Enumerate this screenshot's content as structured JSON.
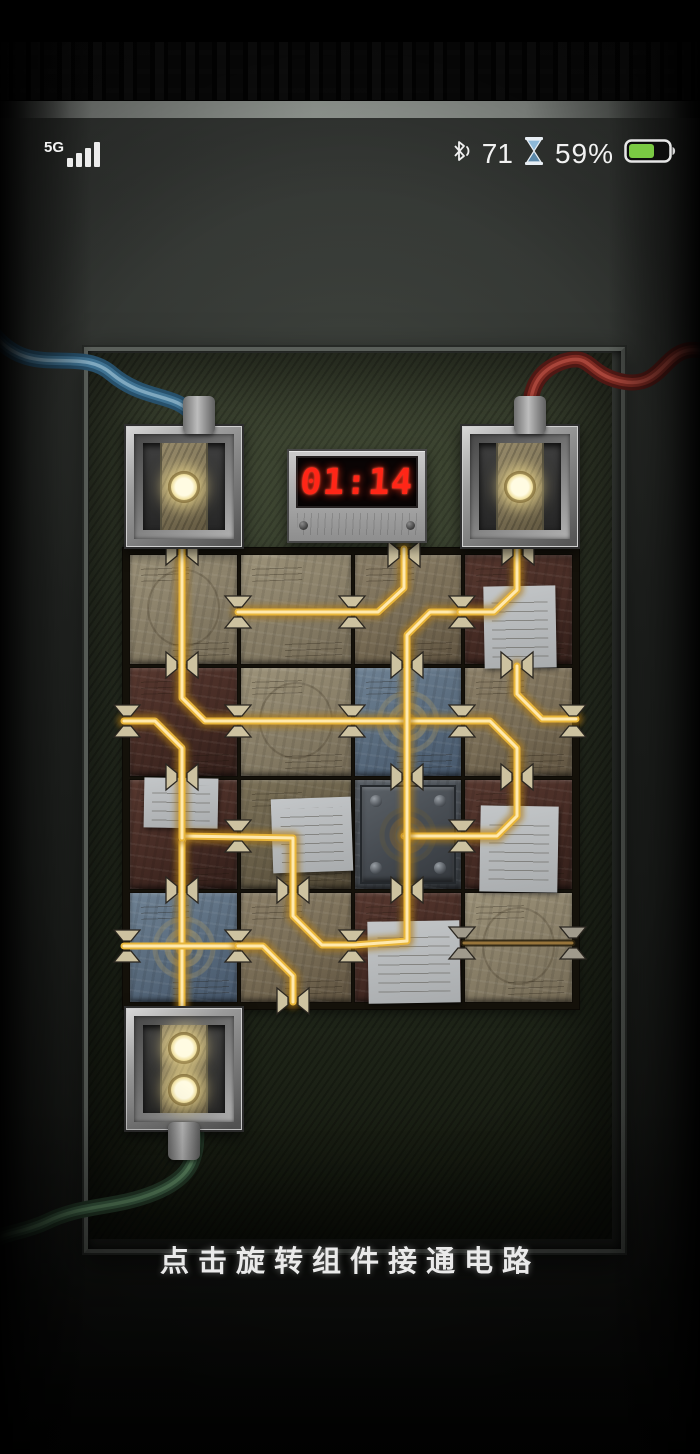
{
  "status_bar": {
    "network": "5G",
    "bluetooth_value": "71",
    "battery_percent": "59%",
    "icons": [
      "signal-bars-icon",
      "bluetooth-icon",
      "hourglass-icon",
      "battery-icon"
    ]
  },
  "timer": {
    "display": "01:14"
  },
  "hint": {
    "text": "点击旋转组件接通电路"
  },
  "palette": {
    "wire_lit_core": "#ffe9ae",
    "wire_lit_mid": "#e9b63a",
    "wire_lit_glow": "#b07c18",
    "wire_dim_core": "#97743a",
    "wire_dim_edge": "#2e2310",
    "clip_lit": "#cdc2a0",
    "clip_dim": "#a09a8c",
    "clip_stroke": "#2a2620",
    "led": "#f4ecc4",
    "timer_red": "#ff2617",
    "battery_green": "#7ac943",
    "cable_blue": "#3f7292",
    "cable_red": "#7e2a22",
    "cable_green": "#3f6347"
  },
  "board": {
    "tiles": [
      {
        "x": 129,
        "y": 554,
        "w": 107,
        "h": 109,
        "t": "tanA",
        "d": "circle"
      },
      {
        "x": 240,
        "y": 554,
        "w": 110,
        "h": 109,
        "t": "tanA",
        "d": ""
      },
      {
        "x": 354,
        "y": 554,
        "w": 106,
        "h": 109,
        "t": "tanB",
        "d": ""
      },
      {
        "x": 464,
        "y": 554,
        "w": 107,
        "h": 109,
        "t": "mar",
        "d": ""
      },
      {
        "x": 129,
        "y": 667,
        "w": 107,
        "h": 108,
        "t": "mar",
        "d": ""
      },
      {
        "x": 240,
        "y": 667,
        "w": 110,
        "h": 108,
        "t": "tanA",
        "d": "circle"
      },
      {
        "x": 354,
        "y": 667,
        "w": 106,
        "h": 108,
        "t": "blue",
        "d": ""
      },
      {
        "x": 464,
        "y": 667,
        "w": 107,
        "h": 108,
        "t": "tanB",
        "d": ""
      },
      {
        "x": 129,
        "y": 779,
        "w": 107,
        "h": 109,
        "t": "mar",
        "d": ""
      },
      {
        "x": 240,
        "y": 779,
        "w": 110,
        "h": 109,
        "t": "tanC",
        "d": ""
      },
      {
        "x": 354,
        "y": 779,
        "w": 106,
        "h": 109,
        "t": "steel",
        "d": ""
      },
      {
        "x": 464,
        "y": 779,
        "w": 107,
        "h": 109,
        "t": "mar",
        "d": ""
      },
      {
        "x": 129,
        "y": 892,
        "w": 107,
        "h": 109,
        "t": "blue",
        "d": ""
      },
      {
        "x": 240,
        "y": 892,
        "w": 110,
        "h": 109,
        "t": "tanB",
        "d": ""
      },
      {
        "x": 354,
        "y": 892,
        "w": 106,
        "h": 109,
        "t": "mar",
        "d": ""
      },
      {
        "x": 464,
        "y": 892,
        "w": 107,
        "h": 109,
        "t": "tanA",
        "d": "circle"
      }
    ],
    "notes": [
      {
        "x": 484,
        "y": 586,
        "w": 72,
        "h": 82,
        "r": -1
      },
      {
        "x": 144,
        "y": 778,
        "w": 74,
        "h": 50,
        "r": 1
      },
      {
        "x": 272,
        "y": 798,
        "w": 80,
        "h": 74,
        "r": -2
      },
      {
        "x": 480,
        "y": 806,
        "w": 78,
        "h": 86,
        "r": 1
      },
      {
        "x": 368,
        "y": 921,
        "w": 92,
        "h": 82,
        "r": -1
      }
    ],
    "wires": [
      {
        "lit": true,
        "pts": [
          [
            182,
            541
          ],
          [
            182,
            698
          ],
          [
            205,
            721
          ],
          [
            490,
            721
          ],
          [
            517,
            748
          ],
          [
            517,
            816
          ],
          [
            497,
            836
          ],
          [
            404,
            836
          ]
        ]
      },
      {
        "lit": true,
        "pts": [
          [
            462,
            612
          ],
          [
            430,
            612
          ],
          [
            407,
            635
          ],
          [
            407,
            941
          ],
          [
            354,
            945
          ],
          [
            322,
            945
          ],
          [
            293,
            916
          ],
          [
            293,
            838
          ],
          [
            184,
            836
          ],
          [
            182,
            842
          ],
          [
            182,
            1012
          ]
        ]
      },
      {
        "lit": true,
        "pts": [
          [
            238,
            612
          ],
          [
            378,
            612
          ],
          [
            404,
            588
          ],
          [
            404,
            549
          ]
        ]
      },
      {
        "lit": true,
        "pts": [
          [
            517,
            541
          ],
          [
            517,
            590
          ],
          [
            494,
            612
          ],
          [
            460,
            612
          ]
        ]
      },
      {
        "lit": true,
        "pts": [
          [
            517,
            666
          ],
          [
            517,
            694
          ],
          [
            542,
            719
          ],
          [
            576,
            719
          ]
        ]
      },
      {
        "lit": true,
        "pts": [
          [
            124,
            721
          ],
          [
            155,
            721
          ],
          [
            182,
            748
          ],
          [
            182,
            838
          ]
        ]
      },
      {
        "lit": true,
        "pts": [
          [
            124,
            946
          ],
          [
            240,
            946
          ]
        ]
      },
      {
        "lit": true,
        "pts": [
          [
            238,
            946
          ],
          [
            263,
            946
          ],
          [
            293,
            976
          ],
          [
            293,
            1002
          ]
        ]
      },
      {
        "lit": false,
        "pts": [
          [
            464,
            943
          ],
          [
            572,
            943
          ]
        ]
      }
    ],
    "connectors": [
      {
        "x": 182,
        "y": 552,
        "o": "v",
        "lit": true
      },
      {
        "x": 518,
        "y": 552,
        "o": "v",
        "lit": true
      },
      {
        "x": 404,
        "y": 554,
        "o": "v",
        "lit": true
      },
      {
        "x": 182,
        "y": 665,
        "o": "v",
        "lit": true
      },
      {
        "x": 407,
        "y": 665,
        "o": "v",
        "lit": true
      },
      {
        "x": 517,
        "y": 665,
        "o": "v",
        "lit": true
      },
      {
        "x": 182,
        "y": 777,
        "o": "v",
        "lit": true
      },
      {
        "x": 407,
        "y": 777,
        "o": "v",
        "lit": true
      },
      {
        "x": 517,
        "y": 777,
        "o": "v",
        "lit": true
      },
      {
        "x": 182,
        "y": 890,
        "o": "v",
        "lit": true
      },
      {
        "x": 293,
        "y": 890,
        "o": "v",
        "lit": true
      },
      {
        "x": 407,
        "y": 890,
        "o": "v",
        "lit": true
      },
      {
        "x": 293,
        "y": 1001,
        "o": "v",
        "lit": true
      },
      {
        "x": 238,
        "y": 612,
        "o": "h",
        "lit": true
      },
      {
        "x": 352,
        "y": 612,
        "o": "h",
        "lit": true
      },
      {
        "x": 462,
        "y": 612,
        "o": "h",
        "lit": true
      },
      {
        "x": 127,
        "y": 721,
        "o": "h",
        "lit": true
      },
      {
        "x": 238,
        "y": 721,
        "o": "h",
        "lit": true
      },
      {
        "x": 352,
        "y": 721,
        "o": "h",
        "lit": true
      },
      {
        "x": 462,
        "y": 721,
        "o": "h",
        "lit": true
      },
      {
        "x": 573,
        "y": 721,
        "o": "h",
        "lit": true
      },
      {
        "x": 238,
        "y": 836,
        "o": "h",
        "lit": true
      },
      {
        "x": 462,
        "y": 836,
        "o": "h",
        "lit": true
      },
      {
        "x": 127,
        "y": 946,
        "o": "h",
        "lit": true
      },
      {
        "x": 238,
        "y": 946,
        "o": "h",
        "lit": true
      },
      {
        "x": 352,
        "y": 946,
        "o": "h",
        "lit": true
      },
      {
        "x": 462,
        "y": 943,
        "o": "h",
        "lit": false
      },
      {
        "x": 573,
        "y": 943,
        "o": "h",
        "lit": false
      }
    ],
    "terminals": [
      {
        "name": "terminal-top-left",
        "x": 124,
        "y": 424,
        "w": 116,
        "h": 121,
        "dots": 1,
        "gland": "top",
        "gx": 15
      },
      {
        "name": "terminal-top-right",
        "x": 460,
        "y": 424,
        "w": 116,
        "h": 121,
        "dots": 1,
        "gland": "top",
        "gx": 10
      },
      {
        "name": "terminal-bottom-left",
        "x": 124,
        "y": 1006,
        "w": 116,
        "h": 122,
        "dots": 2,
        "gland": "bottom",
        "gx": 0
      }
    ],
    "cables": [
      {
        "name": "blue-cable",
        "dark": "#27506b",
        "mid": "#3f7292",
        "hi": "#7fa8bf",
        "d": "M -8 332 C 30 382, 78 344, 112 374 C 146 402, 176 392, 194 416 C 202 427, 203 434, 203 448"
      },
      {
        "name": "red-cable",
        "dark": "#4f1814",
        "mid": "#7e2a22",
        "hi": "#a8453a",
        "d": "M 708 352 C 662 338, 668 392, 620 381 C 586 373, 592 352, 562 362 C 534 372, 531 392, 529 414 L 529 448"
      },
      {
        "name": "green-cable",
        "dark": "#253b29",
        "mid": "#3f6347",
        "hi": "#5f8a64",
        "d": "M 196 1126 C 199 1163, 186 1180, 154 1193 C 114 1209, 82 1204, 46 1222 C 22 1233, 6 1232, -8 1241"
      }
    ]
  }
}
